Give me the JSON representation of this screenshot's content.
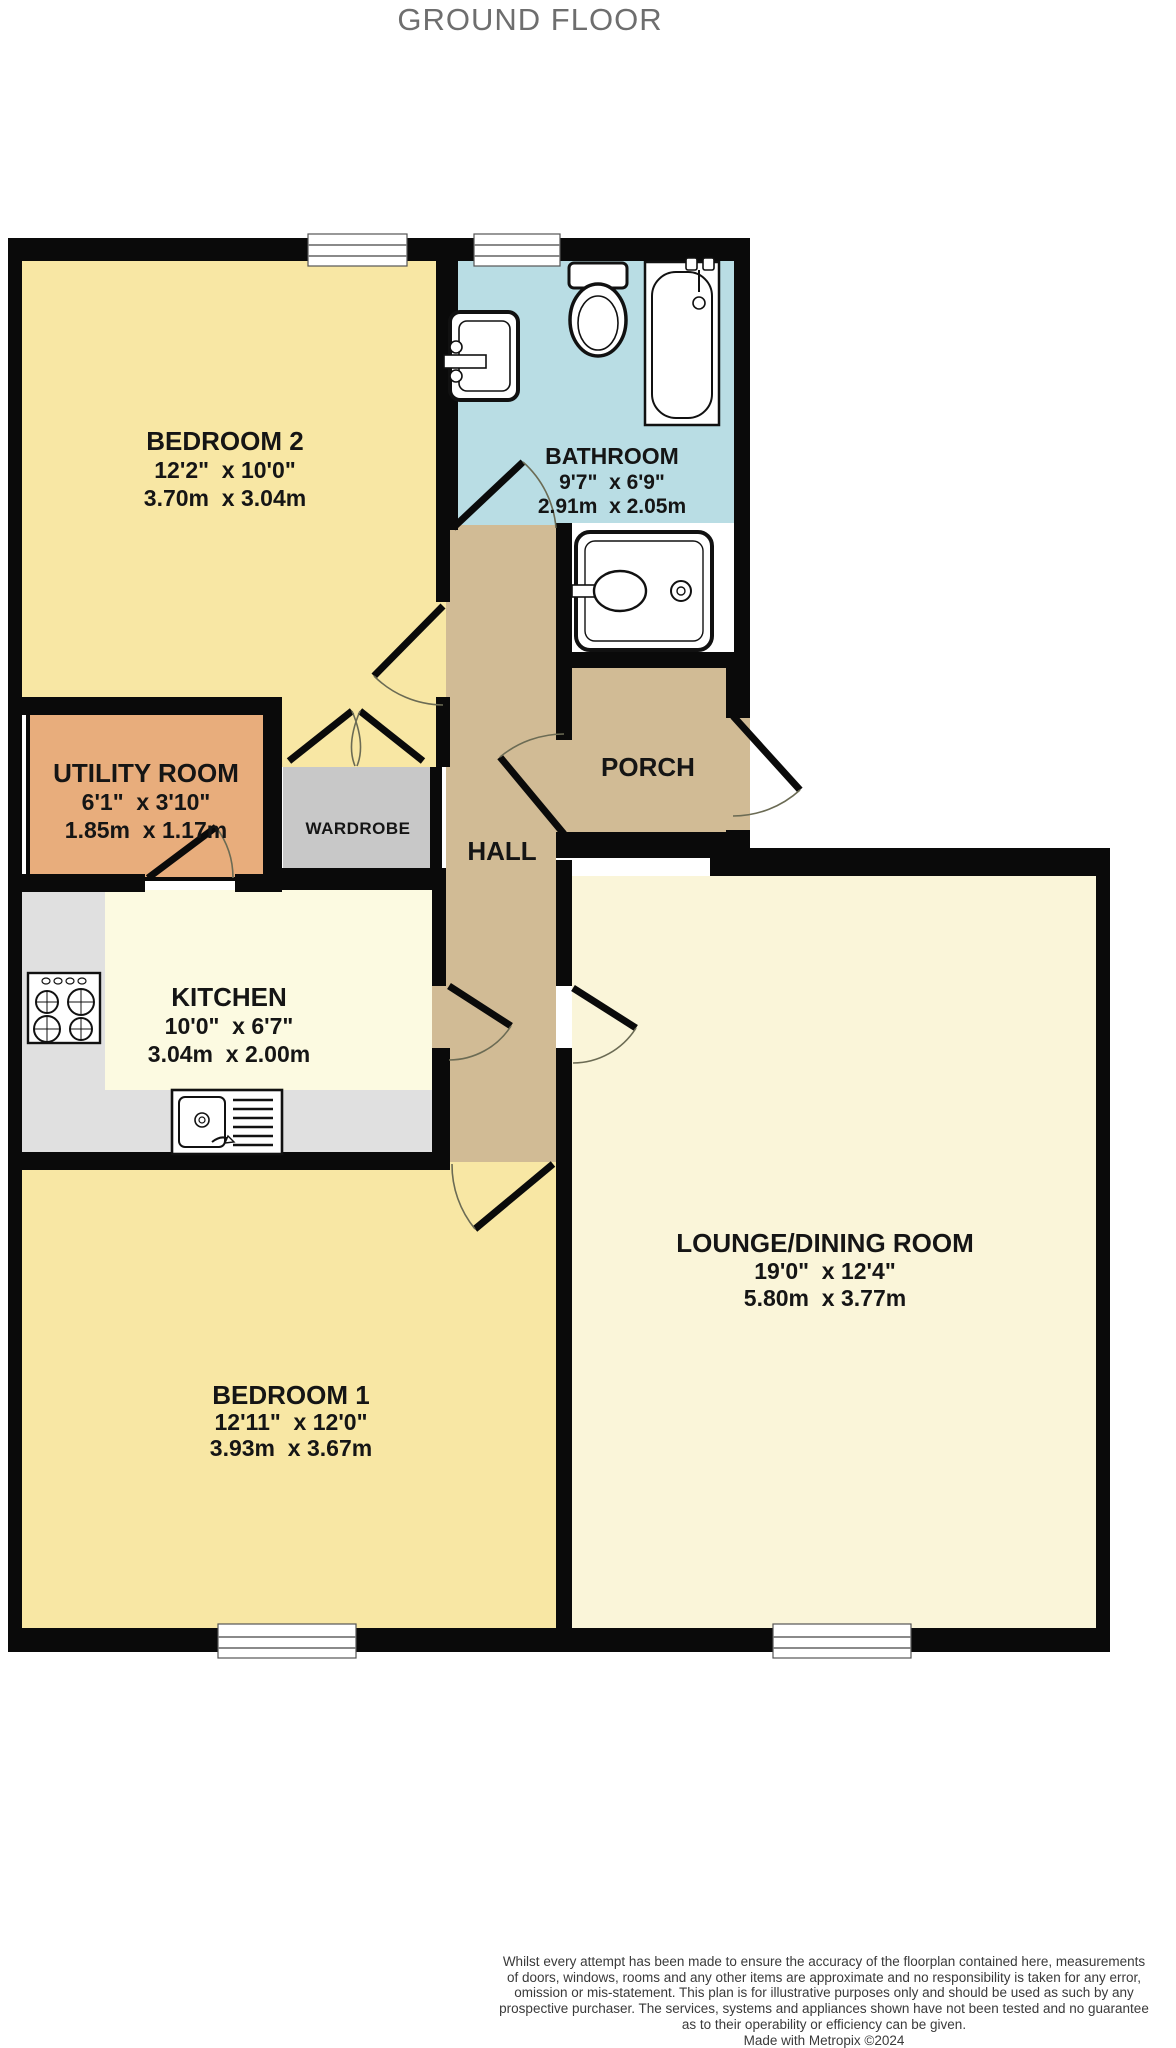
{
  "title": "GROUND FLOOR",
  "colors": {
    "bedroom": "#F8E7A4",
    "bathroom": "#B9DDE4",
    "utility": "#E8AD7C",
    "hall": "#D1BB95",
    "kitchen_floor": "#FCFAE1",
    "lounge_floor": "#FAF5D9",
    "wardrobe_gray": "#C8C8C8",
    "counter_gray": "#E0E0E0",
    "wall_black": "#0A0A0A",
    "niche_white": "#FFFFFF"
  },
  "rooms": {
    "bedroom2": {
      "name": "BEDROOM 2",
      "imperial": "12'2\"  x 10'0\"",
      "metric": "3.70m  x 3.04m"
    },
    "bathroom": {
      "name": "BATHROOM",
      "imperial": "9'7\"  x 6'9\"",
      "metric": "2.91m  x 2.05m"
    },
    "utility": {
      "name": "UTILITY ROOM",
      "imperial": "6'1\"  x 3'10\"",
      "metric": "1.85m  x 1.17m"
    },
    "wardrobe": {
      "name": "WARDROBE"
    },
    "hall": {
      "name": "HALL"
    },
    "porch": {
      "name": "PORCH"
    },
    "kitchen": {
      "name": "KITCHEN",
      "imperial": "10'0\"  x 6'7\"",
      "metric": "3.04m  x 2.00m"
    },
    "lounge": {
      "name": "LOUNGE/DINING ROOM",
      "imperial": "19'0\"  x 12'4\"",
      "metric": "5.80m  x 3.77m"
    },
    "bedroom1": {
      "name": "BEDROOM 1",
      "imperial": "12'11\"  x 12'0\"",
      "metric": "3.93m  x 3.67m"
    }
  },
  "footer": {
    "lines": [
      "Whilst every attempt has been made to ensure the accuracy of the floorplan contained here, measurements",
      "of doors, windows, rooms and any other items are approximate and no responsibility is taken for any error,",
      "omission or mis-statement. This plan is for illustrative purposes only and should be used as such by any",
      "prospective purchaser. The services, systems and appliances shown have not been tested and no guarantee",
      "as to their operability or efficiency can be given."
    ],
    "credit": "Made with Metropix ©2024"
  }
}
